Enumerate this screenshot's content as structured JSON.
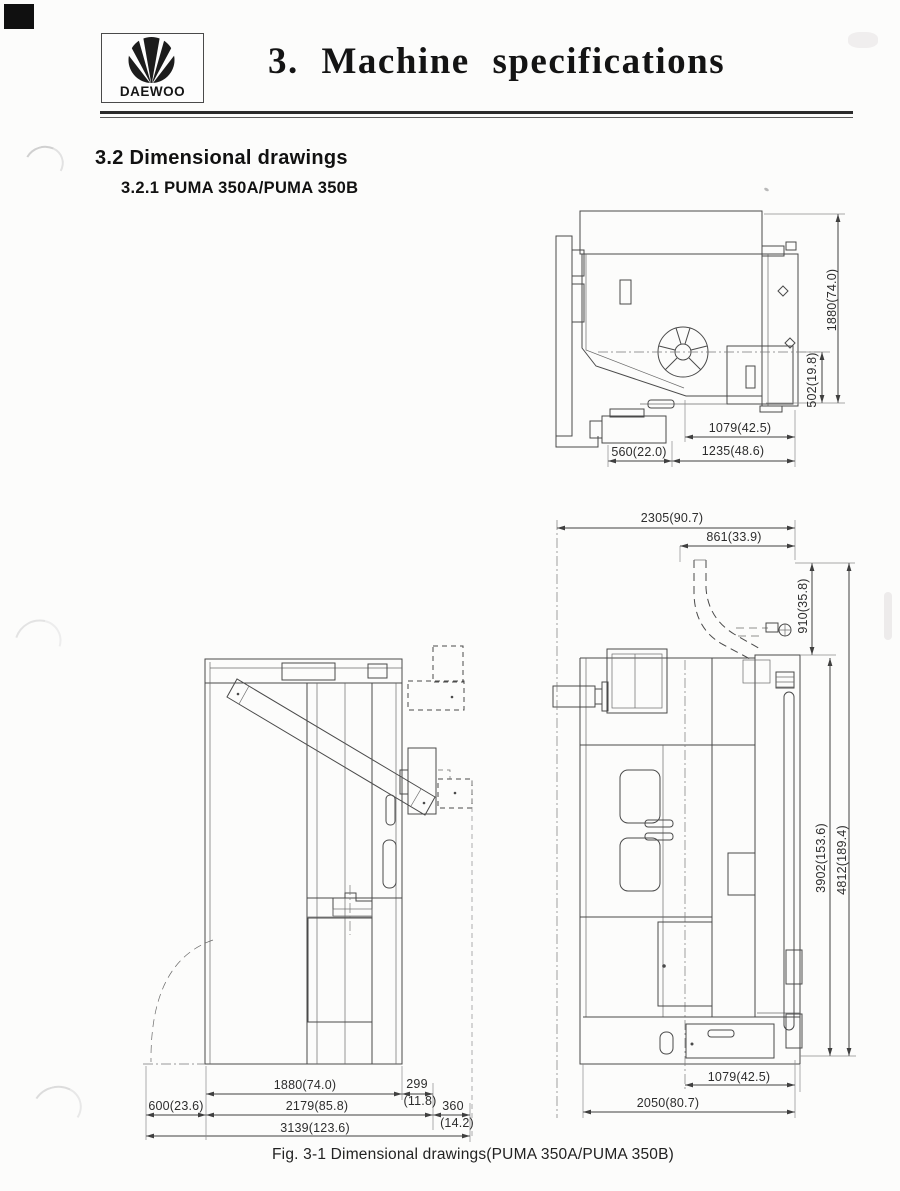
{
  "page": {
    "logo_text": "DAEWOO",
    "title": "3. Machine specifications",
    "section": "3.2 Dimensional drawings",
    "subsection": "3.2.1 PUMA 350A/PUMA 350B",
    "caption": "Fig. 3-1 Dimensional drawings(PUMA 350A/PUMA 350B)"
  },
  "views": {
    "top_view_dims": [
      "1880(74.0)",
      "502(19.8)",
      "1079(42.5)",
      "560(22.0)",
      "1235(48.6)"
    ],
    "side_view_dims": [
      "1880(74.0)",
      "299(11.8)",
      "600(23.6)",
      "2179(85.8)",
      "360(14.2)",
      "3139(123.6)"
    ],
    "front_view_dims": [
      "2305(90.7)",
      "861(33.9)",
      "910(35.8)",
      "3902(153.6)",
      "4812(189.4)",
      "1079(42.5)",
      "2050(80.7)"
    ]
  },
  "labels": {
    "top_1880": "1880(74.0)",
    "top_502": "502(19.8)",
    "top_1079": "1079(42.5)",
    "top_560": "560(22.0)",
    "top_1235": "1235(48.6)",
    "side_1880": "1880(74.0)",
    "side_299": "299",
    "side_299_in": "(11.8)",
    "side_600": "600(23.6)",
    "side_2179": "2179(85.8)",
    "side_360": "360",
    "side_360_in": "(14.2)",
    "side_3139": "3139(123.6)",
    "front_2305": "2305(90.7)",
    "front_861": "861(33.9)",
    "front_910": "910(35.8)",
    "front_3902": "3902(153.6)",
    "front_4812": "4812(189.4)",
    "front_1079": "1079(42.5)",
    "front_2050": "2050(80.7)"
  }
}
